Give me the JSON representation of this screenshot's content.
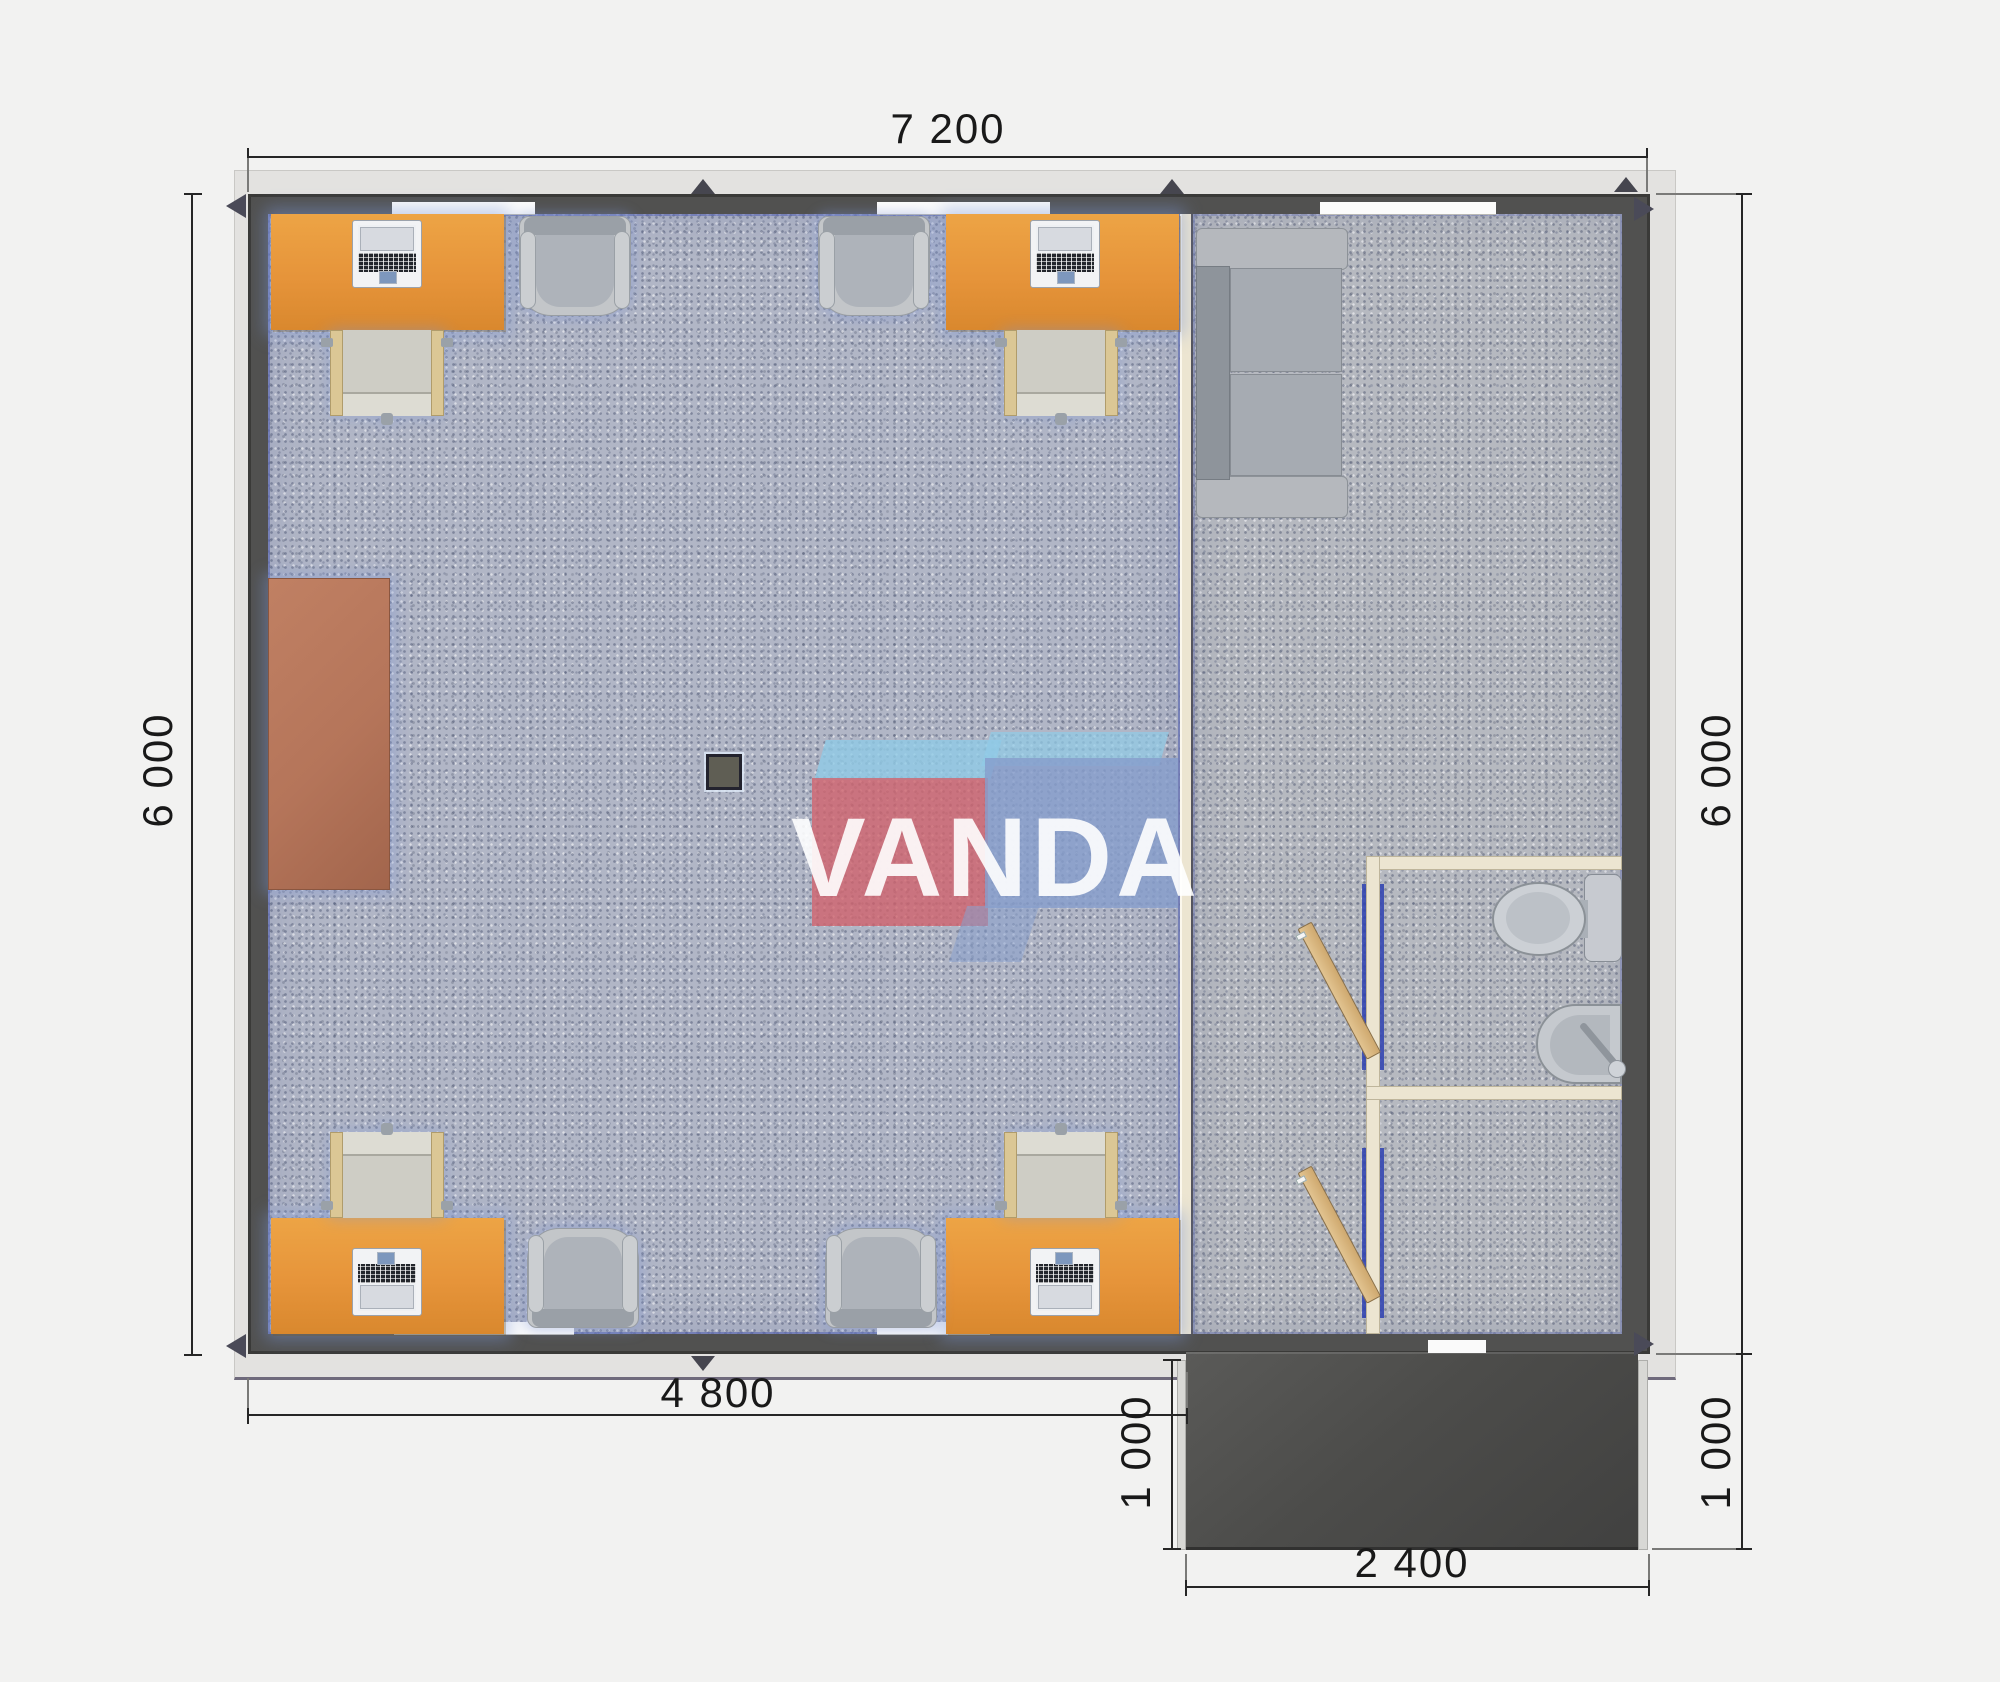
{
  "watermark": {
    "brand": "VANDA"
  },
  "dimensions": {
    "overall_width_mm": "7 200",
    "left_height_mm": "6 000",
    "right_height_mm": "6 000",
    "office_width_mm": "4 800",
    "porch_depth_left_mm": "1 000",
    "porch_depth_right_mm": "1 000",
    "porch_width_mm": "2 400"
  },
  "colors": {
    "desk_orange": "#E9993D",
    "wall_dark": "#4F4F4D",
    "partition_cream": "#ECE5D1",
    "carpet_gray_blue": "#B1B6C6",
    "porch_dark": "#4C4C4A",
    "cabinet_brown": "#B5755A",
    "logo_red": "#D3646E",
    "logo_blue": "#87A0CD",
    "logo_sky": "#8CC8E4",
    "door_frame_blue": "#2D3FB0",
    "door_wood": "#D6B484"
  }
}
